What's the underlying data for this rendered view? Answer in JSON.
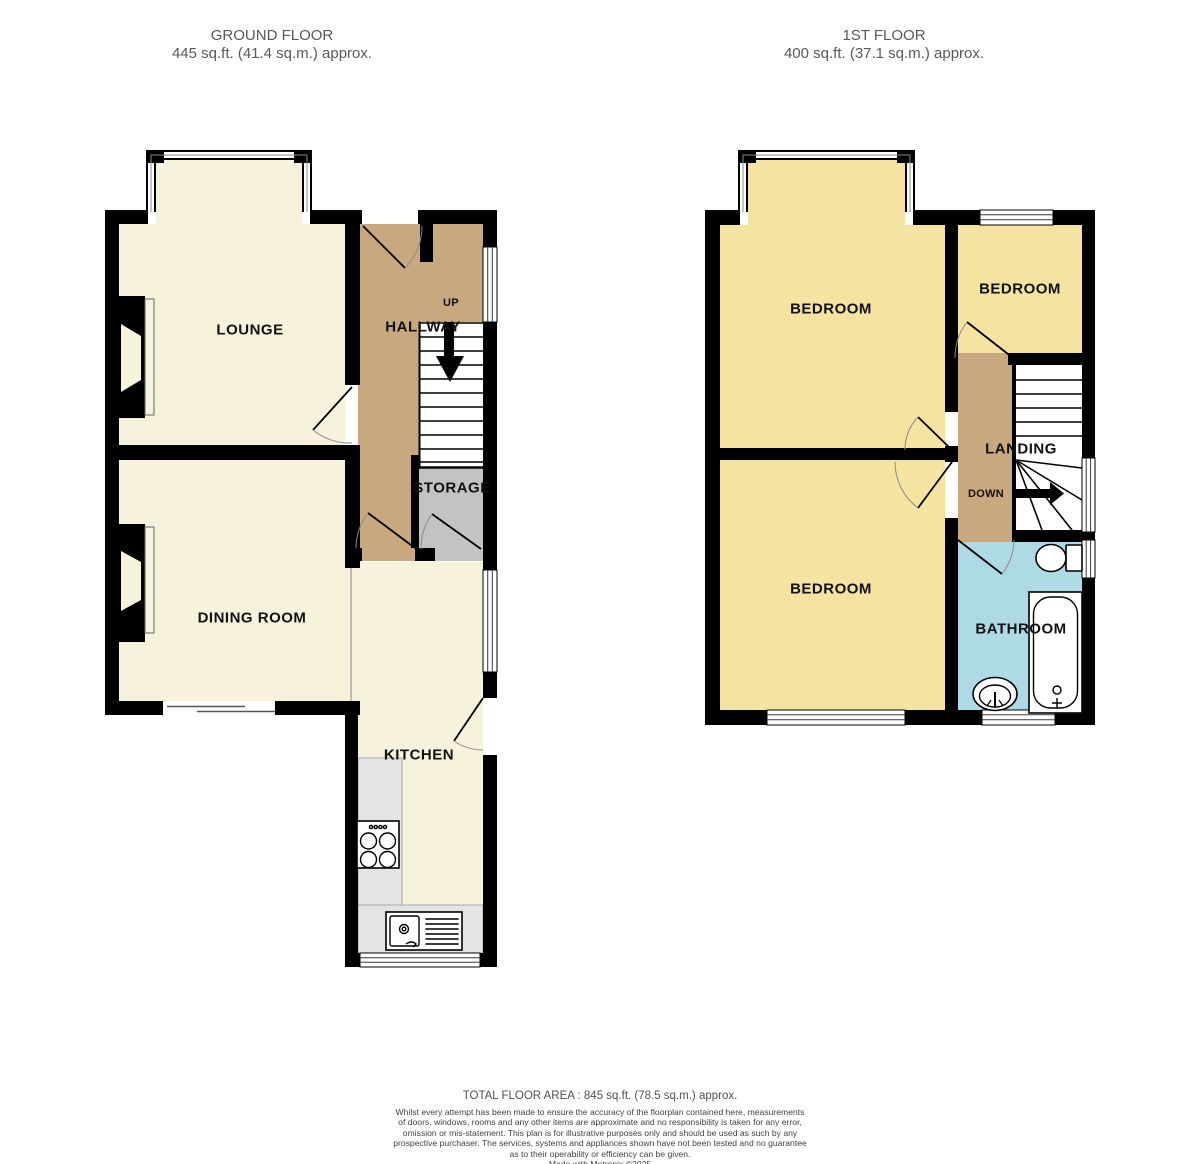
{
  "header": {
    "ground": {
      "title": "GROUND FLOOR",
      "area": "445 sq.ft. (41.4 sq.m.) approx."
    },
    "first": {
      "title": "1ST FLOOR",
      "area": "400 sq.ft. (37.1 sq.m.) approx."
    }
  },
  "rooms": {
    "lounge": "LOUNGE",
    "hallway": "HALLWAY",
    "storage": "STORAGE",
    "dining": "DINING ROOM",
    "kitchen": "KITCHEN",
    "up": "UP",
    "bedroom1": "BEDROOM",
    "bedroom2": "BEDROOM",
    "bedroom3": "BEDROOM",
    "landing": "LANDING",
    "down": "DOWN",
    "bathroom": "BATHROOM"
  },
  "footer": {
    "total": "TOTAL FLOOR AREA : 845 sq.ft. (78.5 sq.m.) approx.",
    "disclaimer_lines": [
      "Whilst every attempt has been made to ensure the accuracy of the floorplan contained here, measurements",
      "of doors, windows, rooms and any other items are approximate and no responsibility is taken for any error,",
      "omission or mis-statement. This plan is for illustrative purposes only and should be used as such by any",
      "prospective purchaser. The services, systems and appliances shown have not been tested and no guarantee",
      "as to their operability or efficiency can be given."
    ],
    "credit": "Made with Metropix ©2025"
  },
  "colors": {
    "cream": "#F7F2DC",
    "bedroom_yellow": "#F5E3A2",
    "hall_tan": "#C8A87E",
    "bath_blue": "#AEDAE5",
    "storage_gray": "#C3C3C3",
    "counter_gray": "#E4E4E4",
    "wall": "#000000",
    "label": "#111111",
    "header_text": "#58585A"
  }
}
